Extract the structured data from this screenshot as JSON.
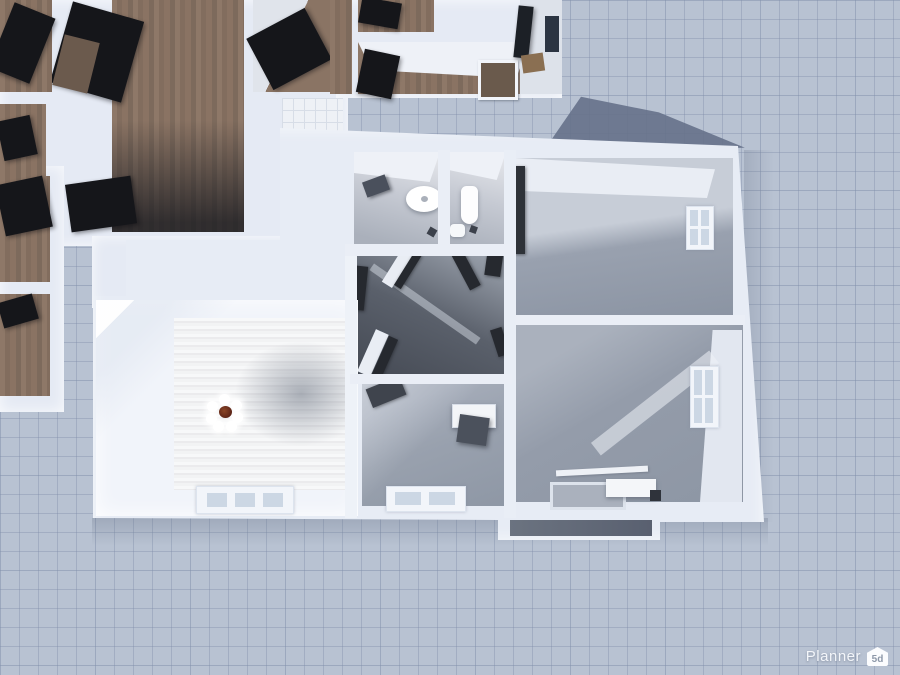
{
  "watermark": {
    "brand": "Planner",
    "logo_text": "5d"
  },
  "scene": {
    "type": "planner5d-3d-floorplan-render",
    "view": "top-down",
    "background_color": "#b8c2d2",
    "grid_color": "#7d8ca8",
    "wall_color": "#e5eaf4",
    "shadow_color": "#66728a",
    "floors": {
      "wood": "#8a7363",
      "white_tile": "#eef1f6",
      "gray_tile": "#ccd2dd",
      "bathroom": "#c6cad3",
      "hallway_dark": "#4e545e",
      "bedroom_gray": "#99a1af",
      "bright_white_plank": "#f2f3f4",
      "balcony": "#6b7380"
    },
    "rooms": [
      {
        "name": "upper-room-large-wood",
        "floor": "wood"
      },
      {
        "name": "upper-room-left-1",
        "floor": "wood"
      },
      {
        "name": "upper-room-left-2",
        "floor": "wood"
      },
      {
        "name": "upper-room-mid",
        "floor": "wood"
      },
      {
        "name": "upper-room-top-1",
        "floor": "wood"
      },
      {
        "name": "upper-room-top-2",
        "floor": "wood"
      },
      {
        "name": "upper-room-corner",
        "floor": "white"
      },
      {
        "name": "laundry-white-tile",
        "floor": "white_tile"
      },
      {
        "name": "kitchen-gray-tile",
        "floor": "gray_tile"
      },
      {
        "name": "bathroom",
        "fixtures": [
          "shower-faucet",
          "washbasin"
        ]
      },
      {
        "name": "wc",
        "fixtures": [
          "pedestal-sink",
          "toilet"
        ]
      },
      {
        "name": "hallway",
        "floor": "hallway_dark"
      },
      {
        "name": "bedroom-top-right",
        "features": [
          "window-east",
          "open-door"
        ]
      },
      {
        "name": "room-bottom-right",
        "features": [
          "window-east",
          "counter",
          "floor-recess"
        ]
      },
      {
        "name": "living-room-bright",
        "features": [
          "chandelier",
          "window-south"
        ]
      },
      {
        "name": "study-room",
        "features": [
          "desk",
          "chair",
          "window-south"
        ]
      },
      {
        "name": "balcony",
        "floor": "balcony"
      }
    ],
    "lighting": {
      "chandelier_globes": 7,
      "chandelier_center_color": "#6e3a20"
    }
  }
}
